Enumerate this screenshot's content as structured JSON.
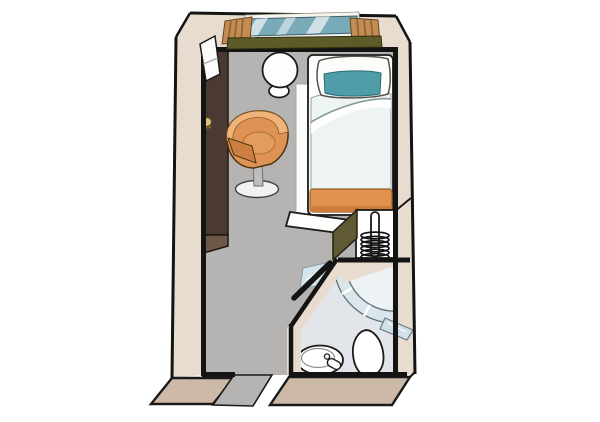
{
  "meta": {
    "kind": "cabin-floor-plan",
    "description": "Top-down illustrated floor plan of a single cabin with window, wardrobe, desk chair, round table, single bed, closet with hanger rail, and en-suite bathroom with curved shower, sink and toilet",
    "canvas": {
      "width": 600,
      "height": 422
    }
  },
  "components": [
    "window-with-curtains",
    "window-sill",
    "tv-panel",
    "wardrobe",
    "wardrobe-knob",
    "round-table",
    "tub-chair",
    "single-bed",
    "pillow",
    "teal-cushion",
    "duvet",
    "bed-runner",
    "footboard",
    "closet-niche",
    "hanger-coil",
    "hanger-rail",
    "bathroom",
    "shower-enclosure",
    "shower-door",
    "sink",
    "faucet",
    "toilet",
    "entrance-opening",
    "bathroom-door"
  ],
  "colors": {
    "bg": "#ffffff",
    "wallFill": "#e8dccf",
    "slabFill": "#cdb9a8",
    "floor": "#b5b4b2",
    "bathFloor": "#e2e5e9",
    "wallLine": "#141414",
    "outline": "#1a1a1a",
    "wardrobeDark": "#4a3a32",
    "wardrobeLight": "#6e5849",
    "knob": "#dcc27f",
    "tvPanel": "#fbfbfa",
    "table": "#fefefe",
    "chairBody": "#de9355",
    "chairRim": "#efb277",
    "chairFront": "#cd7f41",
    "chairStem": "#bebebc",
    "chairBase": "#f1f1ef",
    "bedFrame": "#fdfdfc",
    "pillow": "#fcfcfb",
    "pillowTeal": "#4f9da9",
    "duvet": "#edf4f2",
    "runner": "#e2924e",
    "runnerDark": "#cd7c39",
    "windowGlass": "#79aab8",
    "curtain": "#c28c55",
    "curtainStreak": "#91602f",
    "sill": "#5d5c28",
    "closetOlive": "#605a34",
    "niche": "#ffffff",
    "coil": "#111111",
    "showerBand": "#dbe6ec",
    "showerStall": "#edf2f4",
    "showerEdge": "#66757d",
    "glassPanel": "#cfe0e8",
    "fixture": "#ffffff"
  }
}
